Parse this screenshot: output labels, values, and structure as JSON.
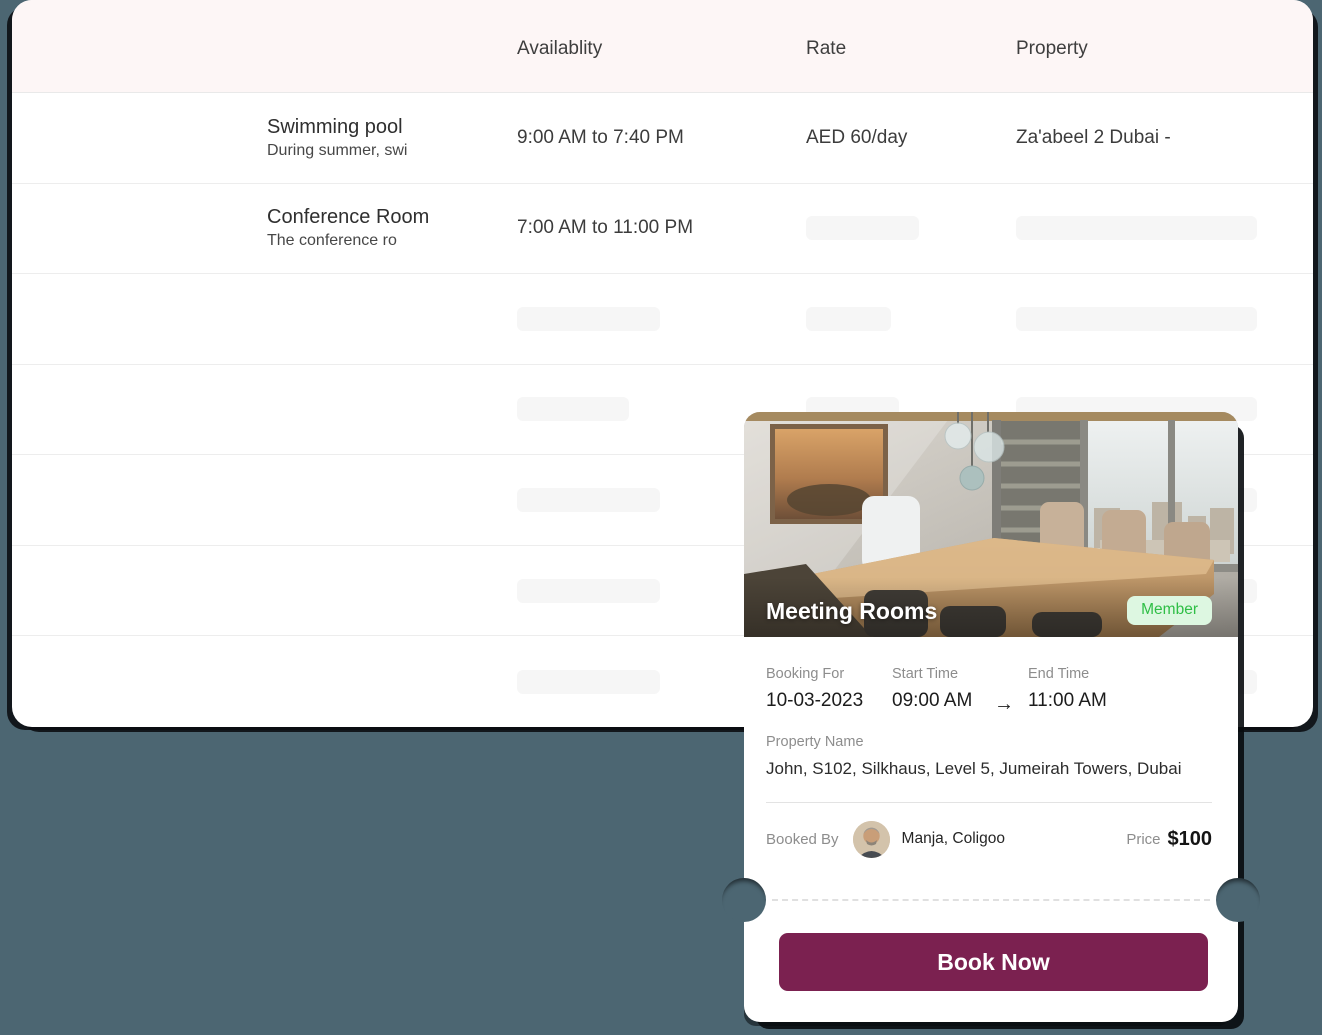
{
  "table": {
    "header": {
      "availability": "Availablity",
      "rate": "Rate",
      "property": "Property"
    },
    "rows": [
      {
        "name": "Swimming pool",
        "description": "During summer, swi",
        "availability": "9:00 AM to 7:40 PM",
        "rate": "AED 60/day",
        "property": "Za'abeel 2 Dubai -"
      },
      {
        "name": "Conference Room",
        "description": "The conference ro",
        "availability": "7:00 AM to 11:00 PM"
      }
    ]
  },
  "booking_card": {
    "title": "Meeting Rooms",
    "badge": "Member",
    "booking_for_label": "Booking For",
    "booking_for_value": "10-03-2023",
    "start_time_label": "Start Time",
    "start_time_value": "09:00 AM",
    "arrow": "→",
    "end_time_label": "End Time",
    "end_time_value": "11:00 AM",
    "property_name_label": "Property Name",
    "property_name_value": "John, S102, Silkhaus, Level 5, Jumeirah Towers, Dubai",
    "booked_by_label": "Booked By",
    "booked_by_value": "Manja, Coligoo",
    "price_label": "Price",
    "price_value": "$100",
    "cta": "Book Now"
  },
  "colors": {
    "page_background": "#4c6672",
    "table_header_background": "#fdf6f6",
    "accent_button": "#7b2150",
    "member_badge_background": "#ddf7e1",
    "member_badge_text": "#2fbe46",
    "skeleton": "#f6f6f6"
  }
}
